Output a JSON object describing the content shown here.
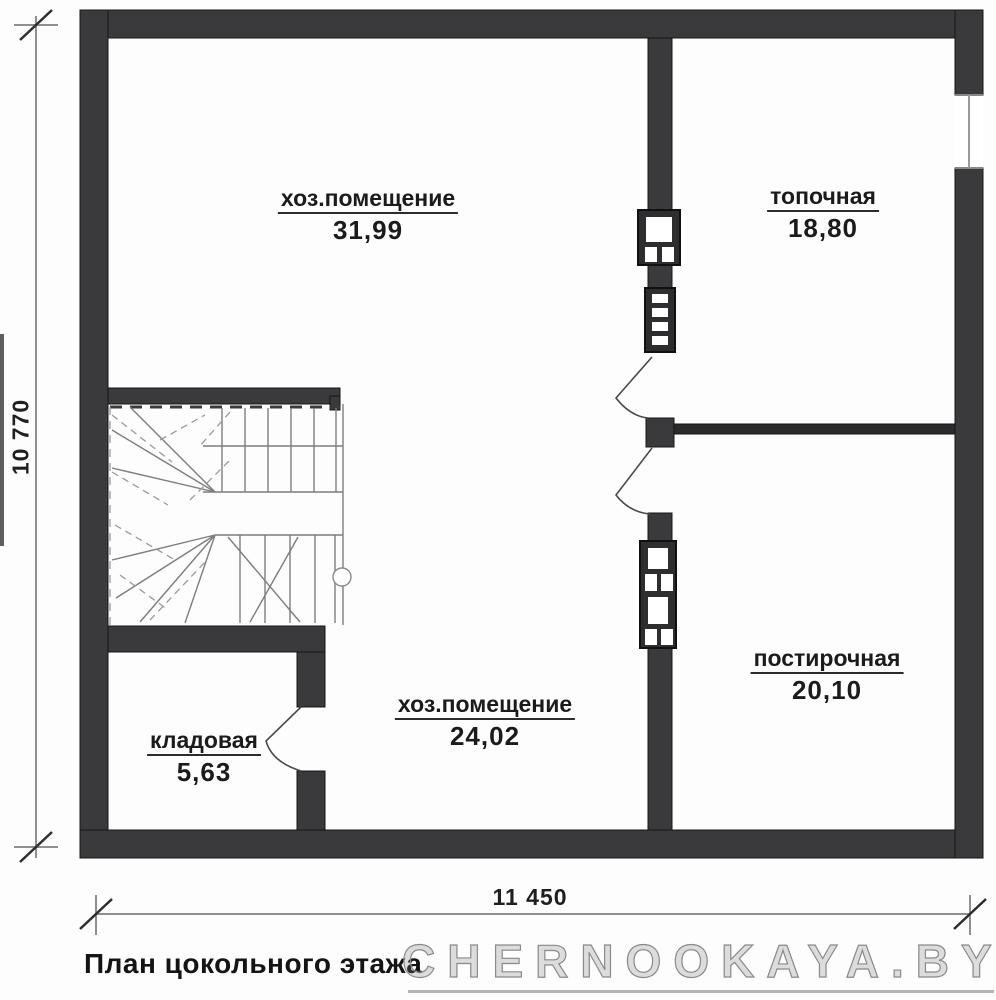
{
  "plan": {
    "title": "План цокольного этажа",
    "watermark": "CHERNOOKAYA.BY",
    "dimensions": {
      "horizontal": "11 450",
      "vertical": "10 770"
    },
    "rooms": [
      {
        "name": "хоз.помещение",
        "area": "31,99"
      },
      {
        "name": "топочная",
        "area": "18,80"
      },
      {
        "name": "постирочная",
        "area": "20,10"
      },
      {
        "name": "хоз.помещение",
        "area": "24,02"
      },
      {
        "name": "кладовая",
        "area": "5,63"
      }
    ],
    "colors": {
      "wall": "#3a3a3c",
      "wall_dark": "#2b2b2d",
      "thin_line": "#7d7d7d",
      "dimension_line": "#8f8f8f",
      "text": "#1b1b1b",
      "watermark": "#8a8a8a"
    }
  }
}
